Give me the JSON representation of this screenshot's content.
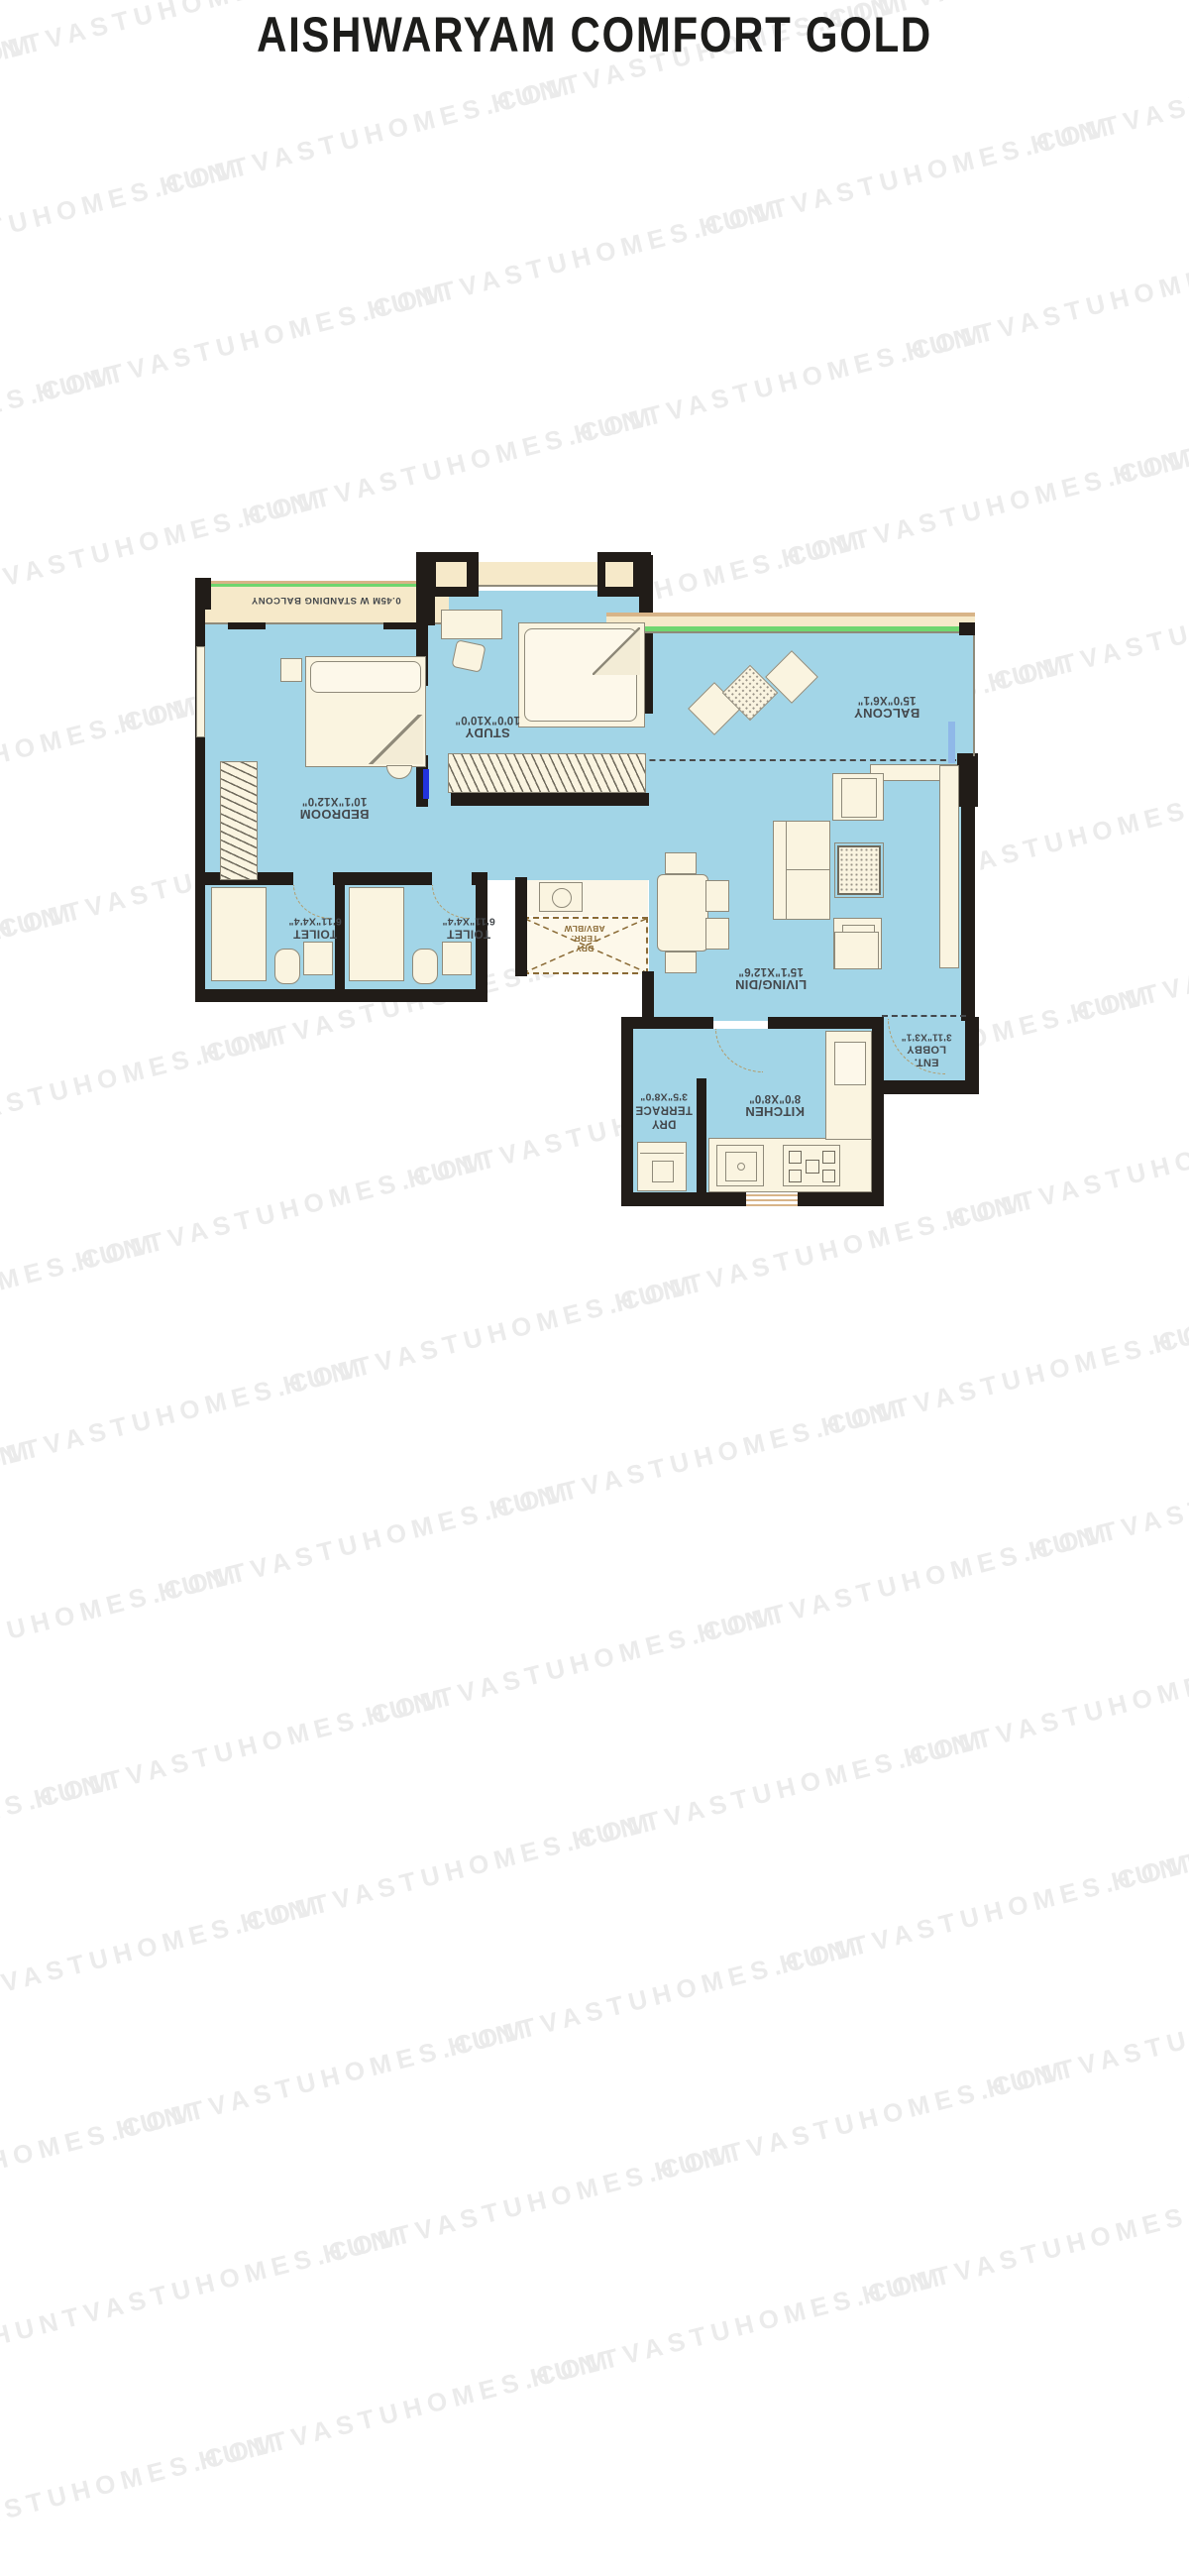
{
  "title": "AISHWARYAM COMFORT GOLD",
  "watermark": {
    "text": "HUNTVASTUHOMES.COM",
    "color": "#ebebeb"
  },
  "colors": {
    "floor_blue": "#a2d5e7",
    "wall_black": "#211c18",
    "furniture_cream": "#faf4e0",
    "balcony_strip_cream": "#f6e9c9",
    "accent_green": "#6fd66f",
    "accent_tan": "#d8b488",
    "label_text": "#44484c",
    "title_text": "#1d1d1b"
  },
  "rooms": {
    "standing_balcony": {
      "name": "0.45M W STANDING BALCONY"
    },
    "bedroom": {
      "name": "BEDROOM",
      "dims": "10'1\"X12'0\""
    },
    "study": {
      "name": "STUDY",
      "dims": "10'0\"X10'0\""
    },
    "balcony": {
      "name": "BALCONY",
      "dims": "15'0\"X6'1\""
    },
    "living": {
      "name": "LIVING/DIN",
      "dims": "15'1\"X12'6\""
    },
    "toilet1": {
      "name": "TOILET",
      "dims": "6'11\"X4'4\""
    },
    "toilet2": {
      "name": "TOILET",
      "dims": "6'11\"X4'4\""
    },
    "dry_terr_abv": {
      "line1": "DRY",
      "line2": "TERR.",
      "line3": "ABV/BLW"
    },
    "ent_lobby": {
      "name": "ENT.",
      "name2": "LOBBY",
      "dims": "3'11\"X3'1\""
    },
    "kitchen": {
      "name": "KITCHEN",
      "dims": "8'0\"X8'0\""
    },
    "dry_terrace": {
      "name": "DRY",
      "name2": "TERRACE",
      "dims": "3'5\"X8'0\""
    }
  }
}
